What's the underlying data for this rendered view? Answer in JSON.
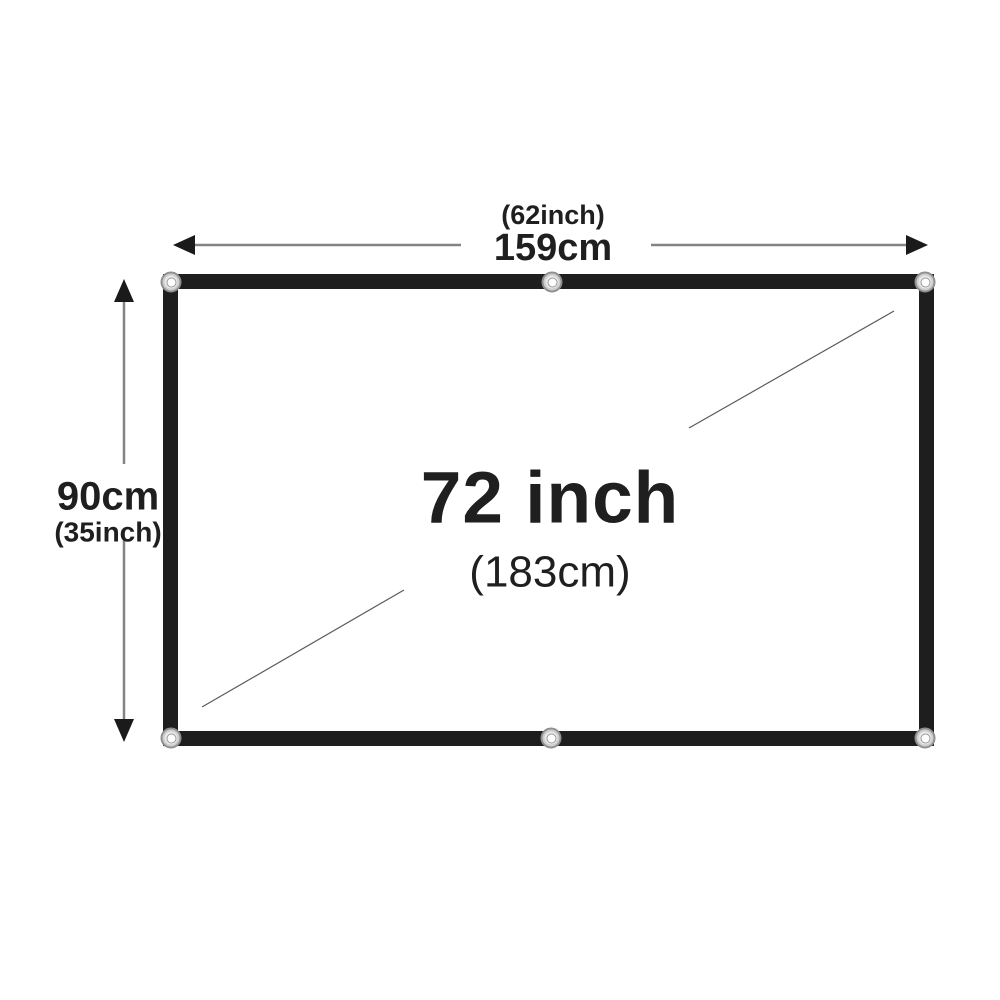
{
  "diagram": {
    "title": "projection-screen-dimension-diagram",
    "width_label": {
      "inches": "(62inch)",
      "cm": "159cm"
    },
    "height_label": {
      "cm": "90cm",
      "inches": "(35inch)"
    },
    "diagonal_label": {
      "inches": "72 inch",
      "cm": "(183cm)"
    },
    "grommet_positions": [
      "top-left",
      "top-center",
      "top-right",
      "bottom-left",
      "bottom-center",
      "bottom-right"
    ],
    "colors": {
      "background": "#ffffff",
      "screen_border": "#1e1e1e",
      "dimension_line": "#848484",
      "arrowhead": "#1a1a1a",
      "diagonal_line": "#5a5a5a",
      "text": "#1f1f1f",
      "grommet_ring": "#8f8f8f"
    }
  }
}
